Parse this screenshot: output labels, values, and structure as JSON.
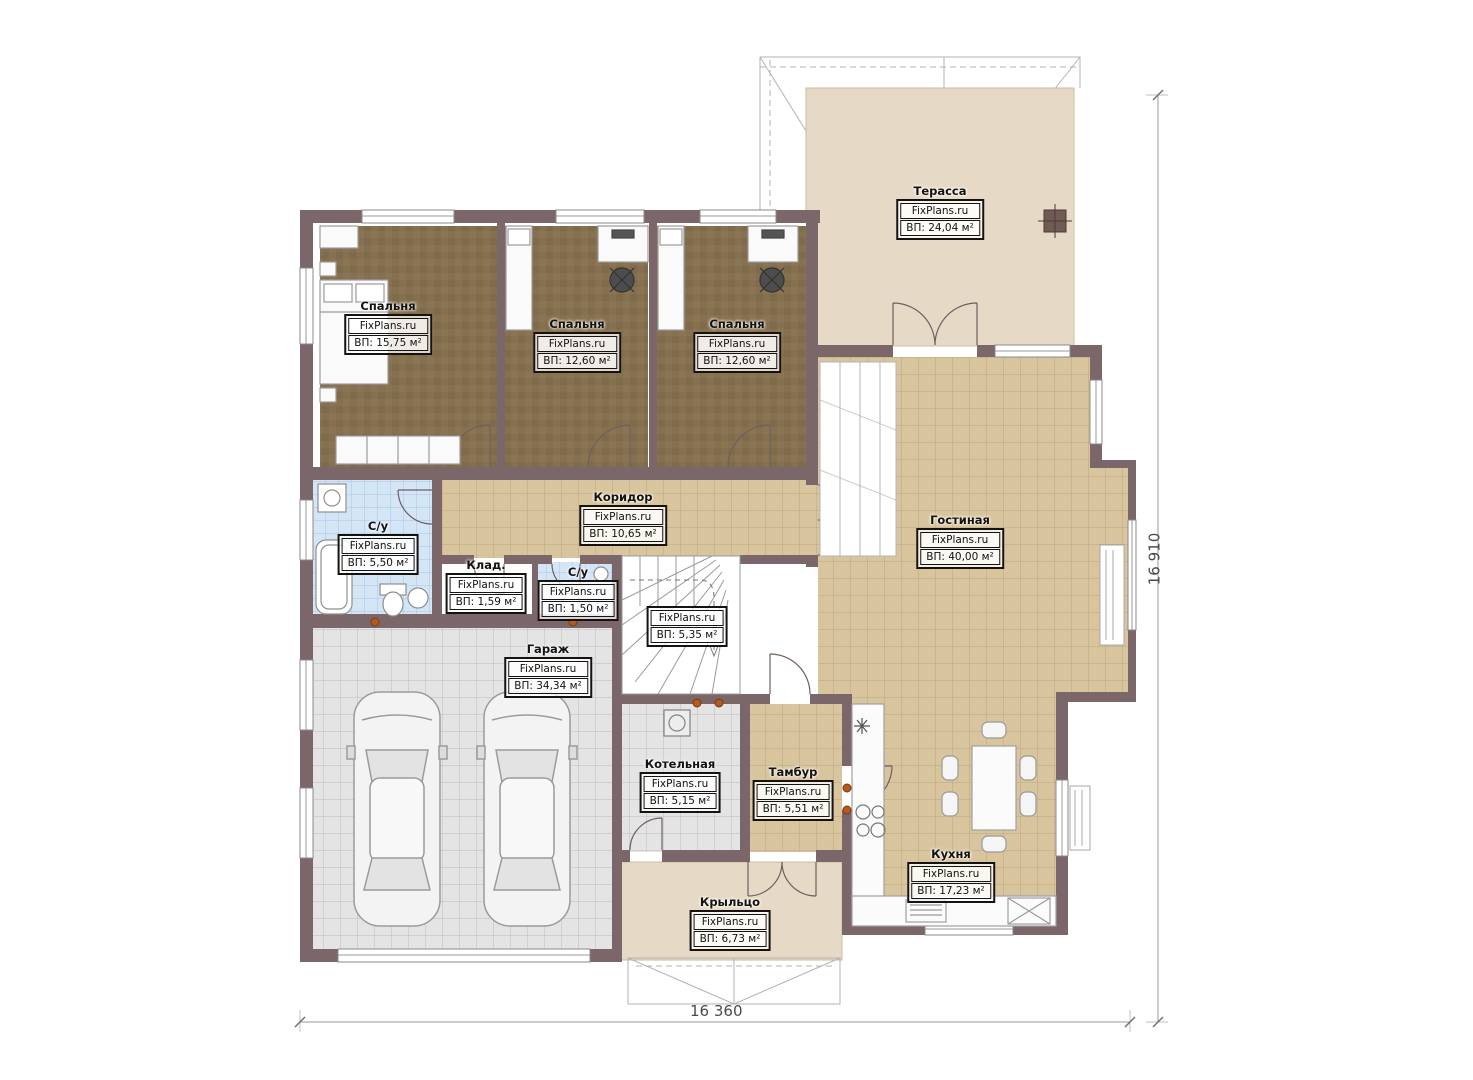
{
  "plan": {
    "brand": "FixPlans.ru",
    "dimensions": {
      "bottom_total": "16 360",
      "right_total": "16 910"
    },
    "colors": {
      "wall": "#7b666a",
      "floor_tan": "#d8c59e",
      "floor_brown": "#85704f",
      "floor_blue": "#d4e5f6",
      "floor_gray": "#e4e4e4",
      "terrace_beige": "#e6dac6"
    },
    "rooms": [
      {
        "id": "bedroom-1",
        "name": "Спальня",
        "brand": "FixPlans.ru",
        "area": "ВП: 15,75 м²"
      },
      {
        "id": "bedroom-2",
        "name": "Спальня",
        "brand": "FixPlans.ru",
        "area": "ВП: 12,60 м²"
      },
      {
        "id": "bedroom-3",
        "name": "Спальня",
        "brand": "FixPlans.ru",
        "area": "ВП: 12,60 м²"
      },
      {
        "id": "terrace",
        "name": "Терасса",
        "brand": "FixPlans.ru",
        "area": "ВП: 24,04 м²"
      },
      {
        "id": "corridor",
        "name": "Коридор",
        "brand": "FixPlans.ru",
        "area": "ВП: 10,65 м²"
      },
      {
        "id": "bathroom-1",
        "name": "С/у",
        "brand": "FixPlans.ru",
        "area": "ВП: 5,50 м²"
      },
      {
        "id": "storage",
        "name": "Клад.",
        "brand": "FixPlans.ru",
        "area": "ВП: 1,59 м²"
      },
      {
        "id": "bathroom-2",
        "name": "С/у",
        "brand": "FixPlans.ru",
        "area": "ВП: 1,50 м²"
      },
      {
        "id": "stairs",
        "name": "",
        "brand": "FixPlans.ru",
        "area": "ВП: 5,35 м²"
      },
      {
        "id": "living-room",
        "name": "Гостиная",
        "brand": "FixPlans.ru",
        "area": "ВП: 40,00 м²"
      },
      {
        "id": "garage",
        "name": "Гараж",
        "brand": "FixPlans.ru",
        "area": "ВП: 34,34 м²"
      },
      {
        "id": "boiler-room",
        "name": "Котельная",
        "brand": "FixPlans.ru",
        "area": "ВП: 5,15 м²"
      },
      {
        "id": "vestibule",
        "name": "Тамбур",
        "brand": "FixPlans.ru",
        "area": "ВП: 5,51 м²"
      },
      {
        "id": "kitchen",
        "name": "Кухня",
        "brand": "FixPlans.ru",
        "area": "ВП: 17,23 м²"
      },
      {
        "id": "porch",
        "name": "Крыльцо",
        "brand": "FixPlans.ru",
        "area": "ВП: 6,73 м²"
      }
    ]
  }
}
